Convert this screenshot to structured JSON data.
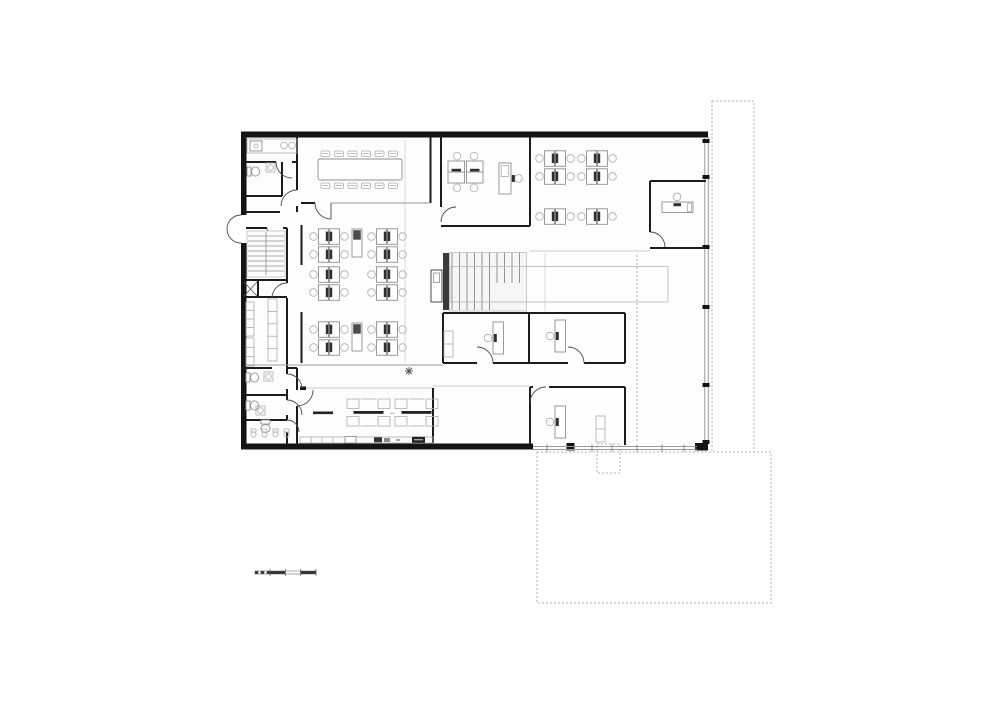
{
  "document": {
    "type": "architectural floor plan",
    "sheet": "office building – ground floor",
    "background": "#ffffff",
    "has_text_labels": false
  },
  "palette": {
    "wall": "#141414",
    "partition": "#1c1c1c",
    "glass_facade": "#9a9a9a",
    "furniture_line": "#8f8f8f",
    "furniture_dark": "#2f2f2f",
    "grid_line": "#dcdcdc",
    "site_dashed": "#b0b0b0",
    "floor": "#fdfdfd"
  },
  "rooms": [
    {
      "id": "kitchenette-nw",
      "function": "kitchenette with sink and hobs"
    },
    {
      "id": "wc-north",
      "function": "WC with toilet and basin"
    },
    {
      "id": "entrance-west",
      "function": "double entrance door in west facade"
    },
    {
      "id": "stair-west",
      "function": "secondary stair"
    },
    {
      "id": "shaft",
      "function": "service shaft"
    },
    {
      "id": "storage-room",
      "function": "storage / copy room with shelving"
    },
    {
      "id": "wc-south",
      "function": "WC block",
      "toilets": 3,
      "urinals": 4
    },
    {
      "id": "conference-room",
      "function": "conference room",
      "seats": 12
    },
    {
      "id": "meeting-office",
      "function": "small office",
      "desks": 4,
      "standing_desk": 1
    },
    {
      "id": "open-office-west",
      "function": "open office",
      "workstations": 24,
      "lockers": 2
    },
    {
      "id": "open-office-east",
      "function": "open office",
      "workstations": 12
    },
    {
      "id": "private-office-ne",
      "function": "private office",
      "desks": 1
    },
    {
      "id": "stair-main",
      "function": "main stair with floor opening"
    },
    {
      "id": "elevator",
      "function": "lift"
    },
    {
      "id": "office-south-a",
      "function": "cellular office",
      "desks": 1
    },
    {
      "id": "office-south-b",
      "function": "cellular office",
      "desks": 1
    },
    {
      "id": "office-south-c",
      "function": "cellular office",
      "desks": 1
    },
    {
      "id": "canteen",
      "function": "canteen",
      "long_tables": 2,
      "side_table": 1,
      "plant": 1
    },
    {
      "id": "kitchen-line",
      "function": "kitchen counter with appliances"
    }
  ],
  "furniture": [
    {
      "symbol": "sym-cluster-v2",
      "positions": [
        [
          309,
          228
        ],
        [
          367,
          228
        ],
        [
          309,
          266
        ],
        [
          367,
          266
        ],
        [
          309,
          321
        ],
        [
          367,
          321
        ],
        [
          535,
          150
        ],
        [
          577,
          150
        ]
      ]
    },
    {
      "symbol": "sym-cluster-v1",
      "positions": [
        [
          535,
          208
        ],
        [
          577,
          208
        ]
      ]
    },
    {
      "symbol": "sym-cluster-h2",
      "positions": [
        [
          447,
          152
        ]
      ]
    },
    {
      "symbol": "sym-lectern",
      "positions": [
        [
          499,
          162
        ]
      ]
    },
    {
      "symbol": "sym-desk-v",
      "positions": [
        [
          484,
          321
        ],
        [
          546,
          319
        ],
        [
          546,
          405
        ]
      ]
    },
    {
      "symbol": "sym-desk-h",
      "positions": [
        [
          661,
          193
        ]
      ]
    },
    {
      "symbol": "sym-locker",
      "positions": [
        [
          352,
          229
        ],
        [
          352,
          323
        ]
      ]
    },
    {
      "symbol": "sym-cab",
      "positions": [
        [
          444,
          331
        ],
        [
          596,
          416
        ]
      ]
    },
    {
      "symbol": "sym-canteen-table",
      "positions": [
        [
          347,
          399
        ],
        [
          395,
          399
        ]
      ]
    },
    {
      "symbol": "sym-chair",
      "positions": [
        [
          321,
          151
        ],
        [
          334.5,
          151
        ],
        [
          348,
          151
        ],
        [
          361.5,
          151
        ],
        [
          375,
          151
        ],
        [
          388.5,
          151
        ],
        [
          321,
          183
        ],
        [
          334.5,
          183
        ],
        [
          348,
          183
        ],
        [
          361.5,
          183
        ],
        [
          375,
          183
        ],
        [
          388.5,
          183
        ]
      ]
    },
    {
      "symbol": "sym-toilet-r",
      "positions": [
        [
          247,
          165
        ],
        [
          246,
          371
        ],
        [
          246,
          399
        ]
      ]
    },
    {
      "symbol": "sym-toilet-d",
      "positions": [
        [
          259,
          420
        ]
      ]
    },
    {
      "symbol": "sym-basin",
      "positions": [
        [
          266,
          163
        ],
        [
          264,
          372
        ],
        [
          256,
          406
        ]
      ]
    },
    {
      "symbol": "sym-urinal",
      "positions": [
        [
          250,
          429
        ],
        [
          261,
          429
        ],
        [
          272,
          429
        ],
        [
          283,
          429
        ]
      ]
    },
    {
      "symbol": "sym-shelf4",
      "positions": [
        [
          246,
          302
        ]
      ]
    },
    {
      "symbol": "sym-shelf3",
      "positions": [
        [
          246,
          338
        ]
      ]
    },
    {
      "symbol": "sym-counter5",
      "positions": [
        [
          268,
          299
        ]
      ]
    },
    {
      "symbol": "sym-plant",
      "positions": [
        [
          405,
          367
        ]
      ]
    }
  ],
  "site": {
    "dashed_rects": [
      {
        "x": 712,
        "y": 101,
        "w": 42,
        "h": 351
      },
      {
        "x": 537,
        "y": 452,
        "w": 234,
        "h": 151
      },
      {
        "x": 597,
        "y": 444,
        "w": 23,
        "h": 29
      }
    ]
  },
  "scale_bar": {
    "x": 255,
    "y": 569,
    "width": 61,
    "subdivisions": 5,
    "segments": [
      "dark",
      "light",
      "dark"
    ]
  }
}
